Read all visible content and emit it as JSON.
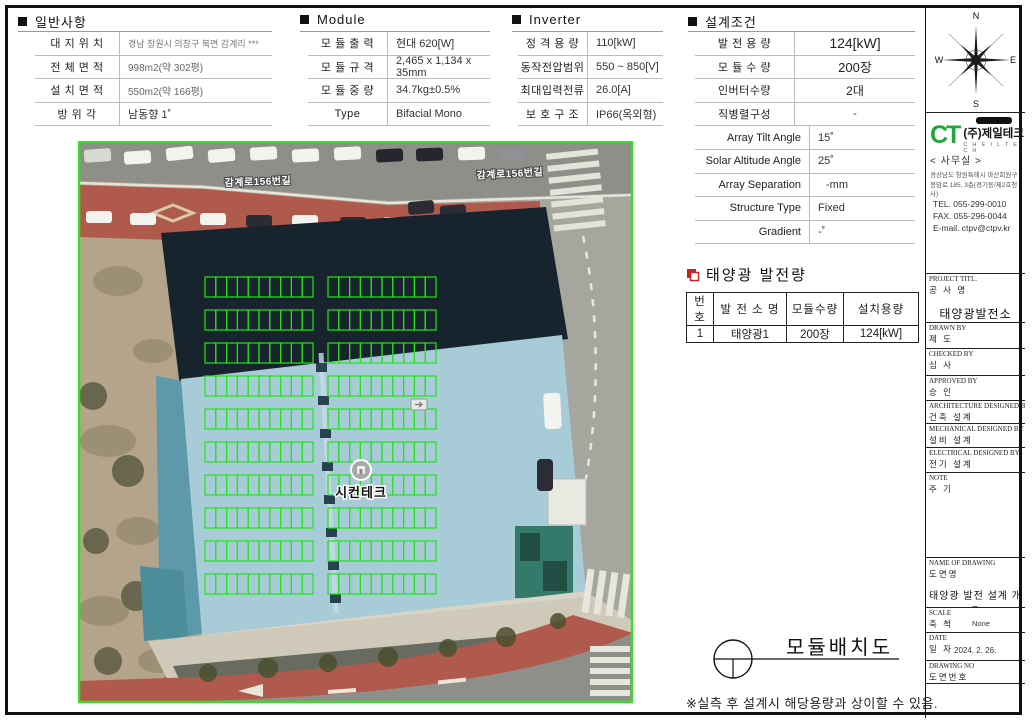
{
  "sections": {
    "general": {
      "title": "일반사항",
      "rows": [
        {
          "label": "대 지 위 치",
          "value": "경남 창원시 의창구 북면 감계리 ***"
        },
        {
          "label": "전 체 면 적",
          "value": "998m2(약 302평)"
        },
        {
          "label": "설 치 면 적",
          "value": "550m2(약 166평)"
        },
        {
          "label": "방 위 각",
          "value": "남동향 1˚"
        }
      ]
    },
    "module": {
      "title": "Module",
      "rows": [
        {
          "label": "모 듈 출 력",
          "value": "현대 620[W]"
        },
        {
          "label": "모 듈 규 격",
          "value": "2,465 x 1,134 x 35mm"
        },
        {
          "label": "모 듈 중 량",
          "value": "34.7kg±0.5%"
        },
        {
          "label": "Type",
          "value": "Bifacial Mono"
        }
      ]
    },
    "inverter": {
      "title": "Inverter",
      "rows": [
        {
          "label": "정 격 용 량",
          "value": "110[kW]"
        },
        {
          "label": "동작전압범위",
          "value": "550 ~ 850[V]"
        },
        {
          "label": "최대입력전류",
          "value": "26.0[A]"
        },
        {
          "label": "보 호 구 조",
          "value": "IP66(옥외형)"
        }
      ]
    },
    "design": {
      "title": "설계조건",
      "rows_a": [
        {
          "label": "발 전 용 량",
          "value": "124[kW]"
        },
        {
          "label": "모 듈 수 량",
          "value": "200장"
        },
        {
          "label": "인버터수량",
          "value": "2대"
        },
        {
          "label": "직병렬구성",
          "value": "-"
        }
      ],
      "rows_b": [
        {
          "label": "Array Tilt Angle",
          "value": "15˚"
        },
        {
          "label": "Solar Altitude Angle",
          "value": "25˚"
        },
        {
          "label": "Array Separation",
          "value": "-mm"
        },
        {
          "label": "Structure Type",
          "value": "Fixed"
        },
        {
          "label": "Gradient",
          "value": "-˚"
        }
      ]
    },
    "generation": {
      "title": "태양광 발전량",
      "headers": [
        "번 호",
        "발 전 소 명",
        "모듈수량",
        "설치용량"
      ],
      "rows": [
        [
          "1",
          "태양광1",
          "200장",
          "124[kW]"
        ]
      ]
    }
  },
  "map": {
    "road_label": "감계로156번길",
    "marker_label": "시컨테크",
    "grid": {
      "blocks": 2,
      "rows": 10,
      "cols": 10,
      "total_modules": 200,
      "line_color": "#22e515"
    }
  },
  "sidebar": {
    "compass": {
      "n": "N",
      "s": "S",
      "e": "E",
      "w": "W"
    },
    "company": {
      "logo_text": "CT",
      "name": "(주)제일테크",
      "name_sub": "C H E I L T E C H",
      "office": "< 사무실 >",
      "address1": "경상남도 창원특례시 마산회원구",
      "address2": "봉암로 185, 3층(경기동/제2호청사)",
      "tel": "TEL. 055-299-0010",
      "fax": "FAX. 055-296-0044",
      "email": "E-mail. ctpv@ctpv.kr"
    },
    "titleblock": [
      {
        "en": "PROJECT TITL.",
        "ko": "공 사 명",
        "value": "태양광발전소"
      },
      {
        "en": "DRAWN BY",
        "ko": "제 도",
        "value": ""
      },
      {
        "en": "CHECKED BY",
        "ko": "심 사",
        "value": ""
      },
      {
        "en": "APPROVED BY",
        "ko": "승 인",
        "value": ""
      },
      {
        "en": "ARCHITECTURE DESIGNED BY",
        "ko": "건축 설계",
        "value": ""
      },
      {
        "en": "MECHANICAL DESIGNED BY",
        "ko": "설비 설계",
        "value": ""
      },
      {
        "en": "ELECTRICAL DESIGNED BY",
        "ko": "전기 설계",
        "value": ""
      },
      {
        "en": "NOTE",
        "ko": "주 기",
        "value": ""
      },
      {
        "en": "NAME OF DRAWING",
        "ko": "도면명",
        "value": "태양광 발전 설계 개요"
      },
      {
        "en": "SCALE",
        "ko": "축 척",
        "value": "None"
      },
      {
        "en": "DATE",
        "ko": "일 자",
        "value": "2024. 2. 26."
      },
      {
        "en": "DRAWING NO",
        "ko": "도면번호",
        "value": ""
      }
    ]
  },
  "footer": {
    "drawing_title": "모듈배치도",
    "note": "※실측 후 설계시 해당용량과 상이할 수 있음."
  },
  "colors": {
    "grid_green": "#22e515",
    "roof_blue": "#a7cbd7",
    "accent_red": "#cc2222"
  }
}
